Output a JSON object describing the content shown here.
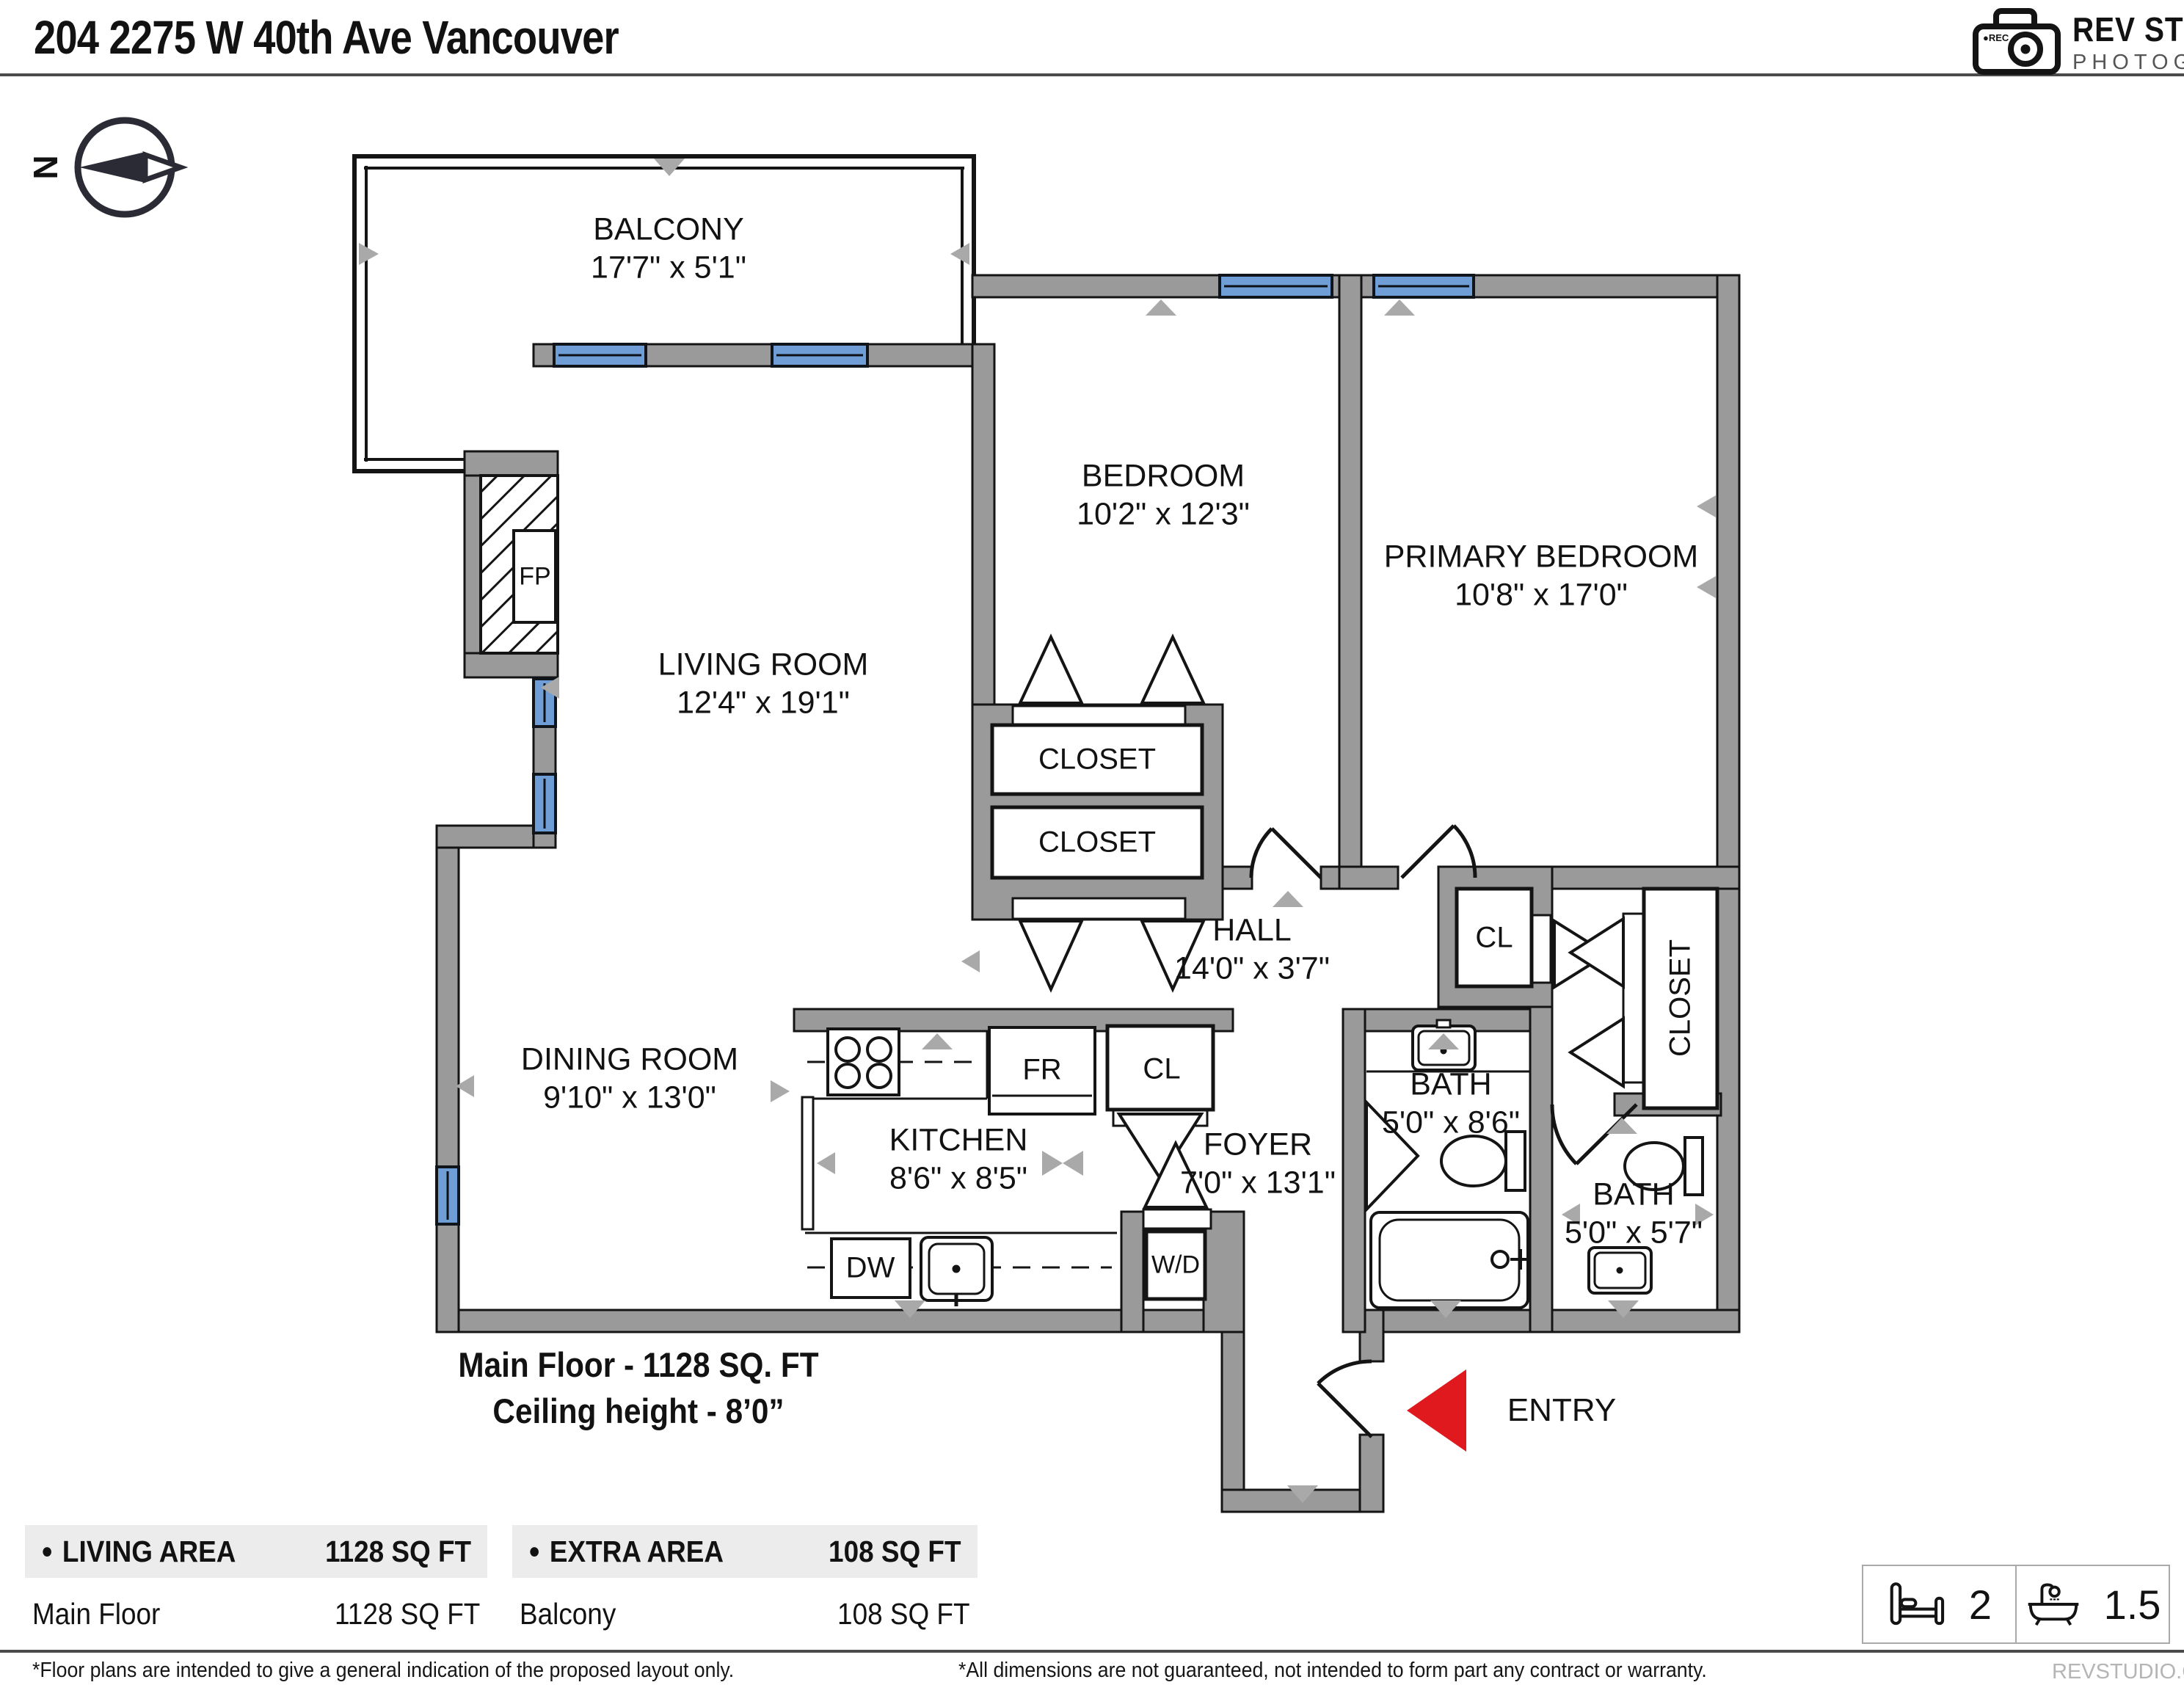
{
  "header": {
    "title": "204 2275 W 40th Ave Vancouver"
  },
  "logo": {
    "brand": "REV STUDIO",
    "subtitle": "PHOTOGRAPHY",
    "rec_label": "●REC"
  },
  "compass": {
    "north_label": "N"
  },
  "rooms": [
    {
      "name": "BALCONY",
      "dims": "17'7\" x 5'1\""
    },
    {
      "name": "BEDROOM",
      "dims": "10'2\" x 12'3\""
    },
    {
      "name": "PRIMARY BEDROOM",
      "dims": "10'8\" x 17'0\""
    },
    {
      "name": "LIVING ROOM",
      "dims": "12'4\" x 19'1\""
    },
    {
      "name": "DINING ROOM",
      "dims": "9'10\" x 13'0\""
    },
    {
      "name": "KITCHEN",
      "dims": "8'6\" x 8'5\""
    },
    {
      "name": "HALL",
      "dims": "14'0\" x 3'7\""
    },
    {
      "name": "FOYER",
      "dims": "7'0\" x 13'1\""
    },
    {
      "name": "BATH",
      "dims": "5'0\" x 8'6\""
    },
    {
      "name": "BATH",
      "dims": "5'0\" x 5'7\""
    }
  ],
  "labels": {
    "closet_upper": "CLOSET",
    "closet_lower": "CLOSET",
    "closet_hall": "CL",
    "closet_primary": "CLOSET",
    "closet_kitchen": "CL",
    "fireplace": "FP",
    "fridge": "FR",
    "dishwasher": "DW",
    "washer_dryer": "W/D",
    "entry": "ENTRY"
  },
  "floor_info": {
    "line1": "Main Floor - 1128 SQ. FT",
    "line2": "Ceiling height - 8’0”"
  },
  "area_tables": [
    {
      "bullet": "●",
      "header_label": "LIVING AREA",
      "header_value": "1128 SQ FT",
      "row_label": "Main Floor",
      "row_value": "1128 SQ FT"
    },
    {
      "bullet": "●",
      "header_label": "EXTRA AREA",
      "header_value": "108 SQ FT",
      "row_label": "Balcony",
      "row_value": "108 SQ FT"
    }
  ],
  "stats": {
    "beds": "2",
    "baths": "1.5"
  },
  "footer": {
    "disclaimer_left": "*Floor plans are intended to give a general indication of the proposed layout only.",
    "disclaimer_right": "*All dimensions are not guaranteed, not intended to form part any contract or warranty.",
    "brand": "REVSTUDIO.CA"
  },
  "colors": {
    "wall_gray": "#9a9a9a",
    "window_blue": "#6f9ed6",
    "entry_red": "#e0191f",
    "marker_gray": "#a9a9a9",
    "line_black": "#141414"
  }
}
